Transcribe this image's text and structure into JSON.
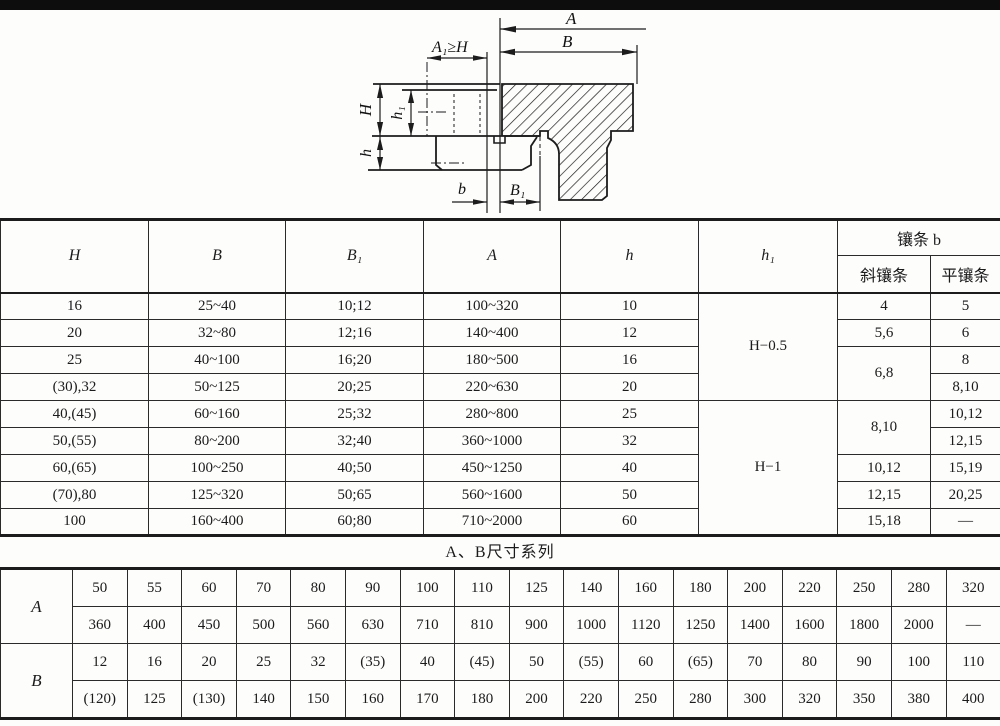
{
  "drawing": {
    "labels": {
      "A": "A",
      "B": "B",
      "A1": "A₁≥H",
      "H": "H",
      "h1": "h₁",
      "h": "h",
      "b": "b",
      "B1": "B₁"
    }
  },
  "main_table": {
    "headers": {
      "H": "H",
      "B": "B",
      "B1": "B₁",
      "A": "A",
      "h": "h",
      "h1": "h₁",
      "gib_b": "镶条 b",
      "oblique_gib": "斜镶条",
      "flat_gib": "平镶条"
    },
    "rows": [
      {
        "H": "16",
        "B": "25~40",
        "B1": "10;12",
        "A": "100~320",
        "h": "10"
      },
      {
        "H": "20",
        "B": "32~80",
        "B1": "12;16",
        "A": "140~400",
        "h": "12"
      },
      {
        "H": "25",
        "B": "40~100",
        "B1": "16;20",
        "A": "180~500",
        "h": "16"
      },
      {
        "H": "(30),32",
        "B": "50~125",
        "B1": "20;25",
        "A": "220~630",
        "h": "20"
      },
      {
        "H": "40,(45)",
        "B": "60~160",
        "B1": "25;32",
        "A": "280~800",
        "h": "25"
      },
      {
        "H": "50,(55)",
        "B": "80~200",
        "B1": "32;40",
        "A": "360~1000",
        "h": "32"
      },
      {
        "H": "60,(65)",
        "B": "100~250",
        "B1": "40;50",
        "A": "450~1250",
        "h": "40"
      },
      {
        "H": "(70),80",
        "B": "125~320",
        "B1": "50;65",
        "A": "560~1600",
        "h": "50"
      },
      {
        "H": "100",
        "B": "160~400",
        "B1": "60;80",
        "A": "710~2000",
        "h": "60"
      }
    ],
    "h1_values": [
      "H−0.5",
      "H−1"
    ],
    "oblique_values": [
      "4",
      "5,6",
      "6,8",
      "8,10",
      "10,12",
      "12,15",
      "15,18"
    ],
    "flat_values": [
      "5",
      "6",
      "8",
      "8,10",
      "10,12",
      "12,15",
      "15,19",
      "20,25",
      "—"
    ]
  },
  "series_table": {
    "title": "A、B尺寸系列",
    "row_labels": [
      "A",
      "B"
    ],
    "A": [
      [
        "50",
        "55",
        "60",
        "70",
        "80",
        "90",
        "100",
        "110",
        "125",
        "140",
        "160",
        "180",
        "200",
        "220",
        "250",
        "280",
        "320"
      ],
      [
        "360",
        "400",
        "450",
        "500",
        "560",
        "630",
        "710",
        "810",
        "900",
        "1000",
        "1120",
        "1250",
        "1400",
        "1600",
        "1800",
        "2000",
        "—"
      ]
    ],
    "B": [
      [
        "12",
        "16",
        "20",
        "25",
        "32",
        "(35)",
        "40",
        "(45)",
        "50",
        "(55)",
        "60",
        "(65)",
        "70",
        "80",
        "90",
        "100",
        "110"
      ],
      [
        "(120)",
        "125",
        "(130)",
        "140",
        "150",
        "160",
        "170",
        "180",
        "200",
        "220",
        "250",
        "280",
        "300",
        "320",
        "350",
        "380",
        "400"
      ]
    ]
  }
}
